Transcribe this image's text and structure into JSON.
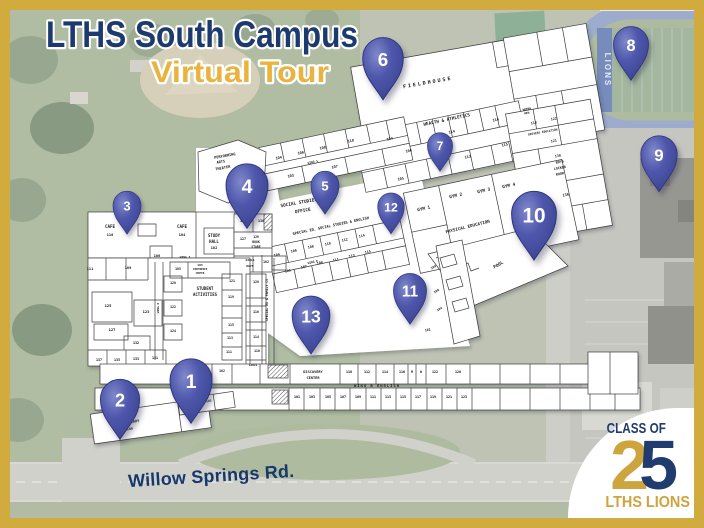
{
  "title": {
    "line1": "LTHS South Campus",
    "line2": "Virtual Tour"
  },
  "road_label": "Willow Springs Rd.",
  "stadium": {
    "end_zone_text": "LIONS"
  },
  "badge": {
    "class_of": "CLASS OF",
    "digit_2": "2",
    "digit_5": "5",
    "lths_lions": "LTHS LIONS"
  },
  "colors": {
    "frame_gold": "#d1ab3d",
    "title_navy": "#1d3a6e",
    "title_gold": "#eab33e",
    "pin_blue": "#4e57ab",
    "plan_paper": "#ffffff",
    "badge_gold": "#cda43e",
    "badge_navy": "#203b6d"
  },
  "pins": [
    {
      "n": "1",
      "x": 191,
      "y": 381,
      "s": 1.5
    },
    {
      "n": "2",
      "x": 120,
      "y": 400,
      "s": 1.4
    },
    {
      "n": "3",
      "x": 127,
      "y": 206,
      "s": 1.0
    },
    {
      "n": "4",
      "x": 247,
      "y": 186,
      "s": 1.5
    },
    {
      "n": "5",
      "x": 325,
      "y": 186,
      "s": 1.0
    },
    {
      "n": "6",
      "x": 383,
      "y": 59,
      "s": 1.45
    },
    {
      "n": "7",
      "x": 440,
      "y": 146,
      "s": 0.9
    },
    {
      "n": "8",
      "x": 631,
      "y": 45,
      "s": 1.25
    },
    {
      "n": "9",
      "x": 659,
      "y": 155,
      "s": 1.3
    },
    {
      "n": "10",
      "x": 534,
      "y": 215,
      "s": 1.6
    },
    {
      "n": "11",
      "x": 410,
      "y": 291,
      "s": 1.18
    },
    {
      "n": "12",
      "x": 391,
      "y": 207,
      "s": 0.95
    },
    {
      "n": "13",
      "x": 311,
      "y": 316,
      "s": 1.35
    }
  ],
  "floor_plan": {
    "labels": [
      {
        "t": "FIELDHOUSE",
        "x": 428,
        "y": 84,
        "r": -10,
        "s": 5,
        "ls": 2
      },
      {
        "t": "HEALTH & ATHLETICS",
        "x": 447,
        "y": 121,
        "r": -12,
        "s": 4.4
      },
      {
        "t": "104",
        "x": 390,
        "y": 140,
        "r": -12,
        "s": 3.6
      },
      {
        "t": "106",
        "x": 409,
        "y": 152,
        "r": -12,
        "s": 3.6
      },
      {
        "t": "114",
        "x": 452,
        "y": 133,
        "r": -12,
        "s": 3.6
      },
      {
        "t": "116",
        "x": 496,
        "y": 121,
        "r": -12,
        "s": 3.6
      },
      {
        "t": "113",
        "x": 468,
        "y": 158,
        "r": -12,
        "s": 3.6
      },
      {
        "t": "115",
        "x": 505,
        "y": 146,
        "r": -12,
        "s": 3.6
      },
      {
        "t": "105",
        "x": 401,
        "y": 180,
        "r": -12,
        "s": 3.6
      },
      {
        "t": "WOMEN",
        "x": 527,
        "y": 110,
        "r": -10,
        "s": 2.8
      },
      {
        "t": "MEN",
        "x": 527,
        "y": 114,
        "r": -10,
        "s": 2.8
      },
      {
        "t": "118",
        "x": 534,
        "y": 124,
        "r": -10,
        "s": 3.4
      },
      {
        "t": "122",
        "x": 554,
        "y": 120,
        "r": -10,
        "s": 3.4
      },
      {
        "t": "DRIVERS EDUCATION",
        "x": 543,
        "y": 133,
        "r": -10,
        "s": 2.9
      },
      {
        "t": "121",
        "x": 554,
        "y": 142,
        "r": -10,
        "s": 3.4
      },
      {
        "t": "130",
        "x": 558,
        "y": 157,
        "r": -10,
        "s": 3.4
      },
      {
        "t": "BOYS",
        "x": 560,
        "y": 163,
        "r": -10,
        "s": 3.4
      },
      {
        "t": "LOCKER",
        "x": 560,
        "y": 169,
        "r": -10,
        "s": 3.4
      },
      {
        "t": "ROOM",
        "x": 560,
        "y": 175,
        "r": -10,
        "s": 3.4
      },
      {
        "t": "136",
        "x": 566,
        "y": 196,
        "r": -10,
        "s": 3.6
      },
      {
        "t": "GYM 1",
        "x": 424,
        "y": 210,
        "r": -12,
        "s": 4.4
      },
      {
        "t": "GYM 2",
        "x": 456,
        "y": 197,
        "r": -12,
        "s": 4.4
      },
      {
        "t": "GYM 3",
        "x": 484,
        "y": 192,
        "r": -12,
        "s": 4.4
      },
      {
        "t": "GYM 4",
        "x": 509,
        "y": 187,
        "r": -12,
        "s": 4.4
      },
      {
        "t": "PHYSICAL EDUCATION",
        "x": 468,
        "y": 228,
        "r": -14,
        "s": 4.2
      },
      {
        "t": "POOL",
        "x": 499,
        "y": 266,
        "r": -30,
        "s": 4.4
      },
      {
        "t": "104",
        "x": 279,
        "y": 159,
        "r": -12,
        "s": 3.6
      },
      {
        "t": "106",
        "x": 301,
        "y": 154,
        "r": -12,
        "s": 3.6
      },
      {
        "t": "108",
        "x": 323,
        "y": 149,
        "r": -12,
        "s": 3.6
      },
      {
        "t": "110",
        "x": 351,
        "y": 142,
        "r": -12,
        "s": 3.6
      },
      {
        "t": "WING 1",
        "x": 313,
        "y": 163,
        "r": -12,
        "s": 2.9
      },
      {
        "t": "103",
        "x": 291,
        "y": 177,
        "r": -12,
        "s": 3.6
      },
      {
        "t": "107",
        "x": 335,
        "y": 168,
        "r": -12,
        "s": 3.6
      },
      {
        "t": "SOCIAL STUDIES",
        "x": 299,
        "y": 204,
        "r": -10,
        "s": 4.4
      },
      {
        "t": "OFFICE",
        "x": 303,
        "y": 212,
        "r": -10,
        "s": 4.4
      },
      {
        "t": "SPECIAL ED, SOCIAL STUDIES & ENGLISH",
        "x": 331,
        "y": 227,
        "r": -12,
        "s": 3.6
      },
      {
        "t": "104",
        "x": 277,
        "y": 256,
        "r": -12,
        "s": 3.4
      },
      {
        "t": "106",
        "x": 294,
        "y": 252,
        "r": -12,
        "s": 3.4
      },
      {
        "t": "108",
        "x": 311,
        "y": 248,
        "r": -12,
        "s": 3.4
      },
      {
        "t": "110",
        "x": 328,
        "y": 245,
        "r": -12,
        "s": 3.4
      },
      {
        "t": "112",
        "x": 345,
        "y": 241,
        "r": -12,
        "s": 3.4
      },
      {
        "t": "114",
        "x": 362,
        "y": 237,
        "r": -12,
        "s": 3.4
      },
      {
        "t": "WING E",
        "x": 313,
        "y": 263,
        "r": -12,
        "s": 2.9
      },
      {
        "t": "105",
        "x": 288,
        "y": 272,
        "r": -12,
        "s": 3.4
      },
      {
        "t": "107",
        "x": 304,
        "y": 268,
        "r": -12,
        "s": 3.4
      },
      {
        "t": "109",
        "x": 320,
        "y": 264,
        "r": -12,
        "s": 3.4
      },
      {
        "t": "111",
        "x": 336,
        "y": 261,
        "r": -12,
        "s": 3.4
      },
      {
        "t": "113",
        "x": 352,
        "y": 257,
        "r": -12,
        "s": 3.4
      },
      {
        "t": "115",
        "x": 368,
        "y": 253,
        "r": -12,
        "s": 3.4
      },
      {
        "t": "PERFORMING",
        "x": 225,
        "y": 157,
        "r": -10,
        "s": 3.6
      },
      {
        "t": "ARTS",
        "x": 221,
        "y": 163,
        "r": -10,
        "s": 3.6
      },
      {
        "t": "THEATER",
        "x": 223,
        "y": 169,
        "r": -10,
        "s": 3.6
      },
      {
        "t": "CAFE",
        "x": 110,
        "y": 228,
        "s": 4.2
      },
      {
        "t": "110",
        "x": 110,
        "y": 236,
        "s": 3.6
      },
      {
        "t": "CAFE",
        "x": 182,
        "y": 228,
        "s": 4.2
      },
      {
        "t": "104",
        "x": 182,
        "y": 236,
        "s": 3.6
      },
      {
        "t": "106",
        "x": 157,
        "y": 257,
        "s": 3.6
      },
      {
        "t": "STUDY",
        "x": 214,
        "y": 237,
        "s": 4
      },
      {
        "t": "HALL",
        "x": 214,
        "y": 243,
        "s": 4
      },
      {
        "t": "102",
        "x": 214,
        "y": 249,
        "s": 3.6
      },
      {
        "t": "125",
        "x": 243,
        "y": 222,
        "s": 3.4
      },
      {
        "t": "130",
        "x": 261,
        "y": 222,
        "s": 3.4
      },
      {
        "t": "127",
        "x": 243,
        "y": 240,
        "s": 3.4
      },
      {
        "t": "129",
        "x": 256,
        "y": 238,
        "s": 3.1
      },
      {
        "t": "BOOK",
        "x": 256,
        "y": 243,
        "s": 3.1
      },
      {
        "t": "STORE",
        "x": 256,
        "y": 248,
        "s": 3.1
      },
      {
        "t": "GIRLS",
        "x": 250,
        "y": 261,
        "s": 3
      },
      {
        "t": "BOYS",
        "x": 250,
        "y": 267,
        "s": 3
      },
      {
        "t": "102",
        "x": 266,
        "y": 263,
        "s": 3.2
      },
      {
        "t": "111",
        "x": 90,
        "y": 270,
        "s": 3.6
      },
      {
        "t": "109",
        "x": 128,
        "y": 269,
        "s": 3.6
      },
      {
        "t": "125",
        "x": 108,
        "y": 307,
        "s": 3.8
      },
      {
        "t": "123",
        "x": 146,
        "y": 313,
        "s": 3.8
      },
      {
        "t": "127",
        "x": 112,
        "y": 331,
        "s": 3.8
      },
      {
        "t": "132",
        "x": 136,
        "y": 344,
        "s": 3.4
      },
      {
        "t": "137",
        "x": 99,
        "y": 361,
        "s": 3.4
      },
      {
        "t": "135",
        "x": 117,
        "y": 361,
        "s": 3.4
      },
      {
        "t": "133",
        "x": 136,
        "y": 360,
        "s": 3.4
      },
      {
        "t": "131",
        "x": 155,
        "y": 359,
        "s": 3.4
      },
      {
        "t": "WING 3",
        "x": 185,
        "y": 258,
        "s": 2.9
      },
      {
        "t": "105",
        "x": 178,
        "y": 270,
        "s": 3.2
      },
      {
        "t": "103",
        "x": 200,
        "y": 266,
        "s": 3
      },
      {
        "t": "CONFERENCE",
        "x": 200,
        "y": 270,
        "s": 2.4
      },
      {
        "t": "CENTER",
        "x": 200,
        "y": 274,
        "s": 2.4
      },
      {
        "t": "WING D",
        "x": 159,
        "y": 308,
        "r": -90,
        "s": 2.9
      },
      {
        "t": "120",
        "x": 173,
        "y": 284,
        "s": 3.2
      },
      {
        "t": "122",
        "x": 173,
        "y": 308,
        "s": 3.2
      },
      {
        "t": "124",
        "x": 173,
        "y": 332,
        "s": 3.2
      },
      {
        "t": "STUDENT",
        "x": 205,
        "y": 290,
        "s": 4
      },
      {
        "t": "ACTIVITIES",
        "x": 205,
        "y": 296,
        "s": 4
      },
      {
        "t": "121",
        "x": 232,
        "y": 282,
        "s": 3.2
      },
      {
        "t": "119",
        "x": 231,
        "y": 298,
        "s": 3.2
      },
      {
        "t": "115",
        "x": 231,
        "y": 326,
        "s": 3.2
      },
      {
        "t": "113",
        "x": 230,
        "y": 339,
        "s": 3.2
      },
      {
        "t": "111",
        "x": 229,
        "y": 353,
        "s": 3.2
      },
      {
        "t": "120",
        "x": 256,
        "y": 283,
        "s": 3.2
      },
      {
        "t": "116",
        "x": 256,
        "y": 313,
        "s": 3.2
      },
      {
        "t": "114",
        "x": 256,
        "y": 338,
        "s": 3.2
      },
      {
        "t": "110",
        "x": 257,
        "y": 352,
        "s": 3.2
      },
      {
        "t": "GIRLS",
        "x": 253,
        "y": 366,
        "s": 2.8
      },
      {
        "t": "SPECIAL ED & FAMILY CS",
        "x": 268,
        "y": 300,
        "r": -90,
        "s": 3.2
      },
      {
        "t": "102",
        "x": 222,
        "y": 372,
        "s": 3.2
      },
      {
        "t": "DISCOVERY",
        "x": 313,
        "y": 373,
        "s": 3.6
      },
      {
        "t": "CENTER",
        "x": 313,
        "y": 379,
        "s": 3.6
      },
      {
        "t": "110",
        "x": 349,
        "y": 373,
        "s": 3.4
      },
      {
        "t": "112",
        "x": 367,
        "y": 373,
        "s": 3.4
      },
      {
        "t": "114",
        "x": 385,
        "y": 373,
        "s": 3.4
      },
      {
        "t": "116",
        "x": 402,
        "y": 373,
        "s": 3.4
      },
      {
        "t": "M",
        "x": 412,
        "y": 373,
        "s": 3.2
      },
      {
        "t": "W",
        "x": 421,
        "y": 373,
        "s": 3.2
      },
      {
        "t": "122",
        "x": 435,
        "y": 373,
        "s": 3.4
      },
      {
        "t": "126",
        "x": 458,
        "y": 373,
        "s": 3.4
      },
      {
        "t": "WING B ENGLISH",
        "x": 377,
        "y": 387,
        "s": 3.8,
        "ls": 1
      },
      {
        "t": "101",
        "x": 297,
        "y": 398,
        "s": 3.4
      },
      {
        "t": "103",
        "x": 312,
        "y": 398,
        "s": 3.4
      },
      {
        "t": "105",
        "x": 328,
        "y": 398,
        "s": 3.4
      },
      {
        "t": "107",
        "x": 343,
        "y": 398,
        "s": 3.4
      },
      {
        "t": "109",
        "x": 358,
        "y": 398,
        "s": 3.4
      },
      {
        "t": "111",
        "x": 373,
        "y": 398,
        "s": 3.4
      },
      {
        "t": "113",
        "x": 388,
        "y": 398,
        "s": 3.4
      },
      {
        "t": "115",
        "x": 403,
        "y": 398,
        "s": 3.4
      },
      {
        "t": "117",
        "x": 418,
        "y": 398,
        "s": 3.4
      },
      {
        "t": "119",
        "x": 433,
        "y": 398,
        "s": 3.4
      },
      {
        "t": "121",
        "x": 449,
        "y": 398,
        "s": 3.4
      },
      {
        "t": "123",
        "x": 464,
        "y": 398,
        "s": 3.4
      },
      {
        "t": "LIBRARY",
        "x": 132,
        "y": 423,
        "r": -8,
        "s": 3.6
      },
      {
        "t": "109",
        "x": 130,
        "y": 430,
        "r": -8,
        "s": 3.4
      },
      {
        "t": "105",
        "x": 190,
        "y": 406,
        "r": -8,
        "s": 3.1
      },
      {
        "t": "103",
        "x": 209,
        "y": 402,
        "r": -8,
        "s": 3.1
      },
      {
        "t": "109",
        "x": 434,
        "y": 268,
        "r": -30,
        "s": 3.2
      },
      {
        "t": "106",
        "x": 437,
        "y": 292,
        "r": -30,
        "s": 3.2
      },
      {
        "t": "104",
        "x": 440,
        "y": 310,
        "r": -30,
        "s": 3.2
      },
      {
        "t": "102",
        "x": 428,
        "y": 331,
        "r": -15,
        "s": 3.2
      }
    ]
  }
}
